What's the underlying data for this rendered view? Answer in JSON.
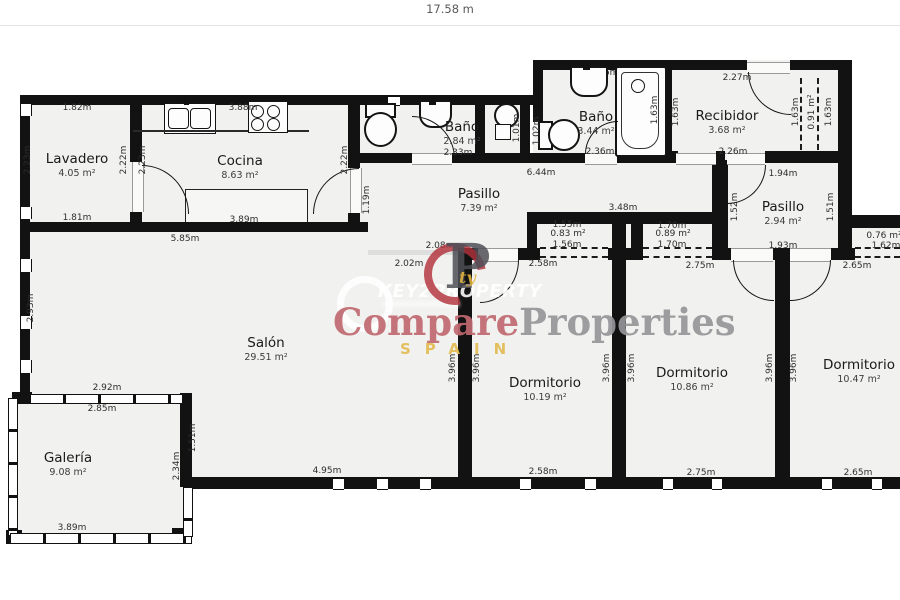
{
  "page": {
    "scale_label": "17.58 m"
  },
  "rooms": {
    "lavadero": {
      "name": "Lavadero",
      "area": "4.05 m²"
    },
    "cocina": {
      "name": "Cocina",
      "area": "8.63 m²"
    },
    "banyo1": {
      "name": "Baño",
      "area": "2.84 m²"
    },
    "banyo2": {
      "name": "Baño",
      "area": "3.44 m²"
    },
    "recibidor": {
      "name": "Recibidor",
      "area": "3.68 m²"
    },
    "pasillo1": {
      "name": "Pasillo",
      "area": "7.39 m²"
    },
    "pasillo2": {
      "name": "Pasillo",
      "area": "2.94 m²"
    },
    "salon": {
      "name": "Salón",
      "area": "29.51 m²"
    },
    "dorm1": {
      "name": "Dormitorio",
      "area": "10.19 m²"
    },
    "dorm2": {
      "name": "Dormitorio",
      "area": "10.86 m²"
    },
    "dorm3": {
      "name": "Dormitorio",
      "area": "10.47 m²"
    },
    "galeria": {
      "name": "Galería",
      "area": "9.08 m²"
    }
  },
  "dims": {
    "lavadero_top": "1.82m",
    "lavadero_bottom": "1.81m",
    "lavadero_left": "2.23m",
    "lavadero_right": "2.22m",
    "cocina_top": "3.88m",
    "cocina_left": "2.23m",
    "cocina_right": "2.22m",
    "cocina_island": "3.89m",
    "cocina_bottom": "5.85m",
    "banyo1_top": "1.90m",
    "banyo1_bottom": "2.33m",
    "shower_w": "1.01m",
    "strip_w": "1.02m",
    "banyo2_top": "1.66m",
    "banyo2_bottom": "2.36m",
    "tub_side": "1.63m",
    "recibidor_top": "2.27m",
    "recibidor_bottom": "2.26m",
    "recibidor_left": "1.63m",
    "closet_rec_left": "1.63m",
    "closet_rec_area": "0.91 m²",
    "closet_rec_right": "1.63m",
    "pasillo1_top": "6.44m",
    "pasillo1_left": "1.19m",
    "pasillo1_right": "3.48m",
    "pasillo2_top": "1.94m",
    "pasillo2_bottom": "1.93m",
    "pasillo2_left": "1.52m",
    "pasillo2_right": "1.51m",
    "salon_left": "2.93m",
    "salon_open_top": "2.08m",
    "salon_open_bottom": "2.02m",
    "salon_bottom": "4.95m",
    "galeria_top_out": "2.92m",
    "galeria_top_in": "2.85m",
    "galeria_right_top": "1.51m",
    "galeria_right_bottom": "2.34m",
    "galeria_bottom": "3.89m",
    "closetA_top": "1.55m",
    "closetA_area": "0.83 m²",
    "closetA_bottom": "1.56m",
    "closetB_top": "1.70m",
    "closetB_area": "0.89 m²",
    "closetB_bottom": "1.70m",
    "closetC_area": "0.76 m²",
    "closetC_w": "1.62m",
    "dorm1_top": "2.58m",
    "dorm1_bottom": "2.58m",
    "dorm2_top": "2.75m",
    "dorm2_bottom": "2.75m",
    "dorm3_top": "2.65m",
    "dorm3_bottom": "2.65m",
    "d396": "3.96m"
  },
  "watermark": {
    "brand_left": "Compare",
    "brand_right": "Properties",
    "brand_sub": "SPAIN",
    "logo_text": "KEY2PROPERTY",
    "monogram_letter": "P",
    "monogram_accent": "ty",
    "colors": {
      "brand_left": "#c06970",
      "brand_right": "#96969a",
      "sub": "#e2bc55",
      "logo_red": "#b2323c"
    }
  }
}
